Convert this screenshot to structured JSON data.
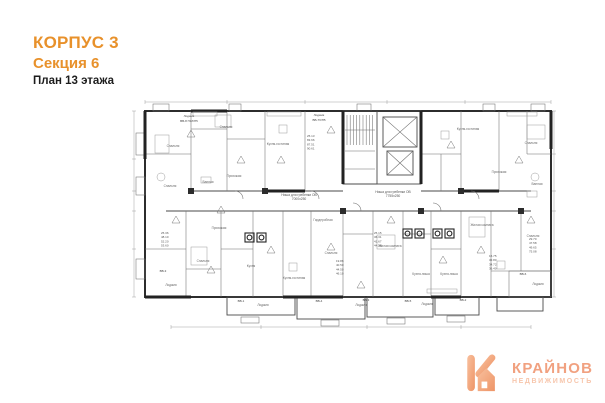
{
  "header": {
    "building": "КОРПУС 3",
    "section": "Секция 6",
    "floor": "План 13 этажа"
  },
  "logo": {
    "name": "КРАЙНОВ",
    "subtitle": "НЕДВИЖИМОСТЬ",
    "accent": "#F0A077"
  },
  "colors": {
    "header_orange": "#E8912B",
    "plan_line": "#3b3b3b",
    "label_gray": "#6b6b6b"
  },
  "plan": {
    "room_labels": [
      {
        "text": "Спальня",
        "x": 42,
        "y": 48
      },
      {
        "text": "Спальня",
        "x": 95,
        "y": 29
      },
      {
        "text": "Кухня-гостиная",
        "x": 147,
        "y": 46
      },
      {
        "text": "Кухня-гостиная",
        "x": 337,
        "y": 31
      },
      {
        "text": "Спальня",
        "x": 400,
        "y": 45
      },
      {
        "text": "Спальня",
        "x": 39,
        "y": 88
      },
      {
        "text": "Прихожая",
        "x": 103,
        "y": 78
      },
      {
        "text": "Ванная",
        "x": 77,
        "y": 84
      },
      {
        "text": "Прихожая",
        "x": 368,
        "y": 74
      },
      {
        "text": "Ванная",
        "x": 406,
        "y": 86
      },
      {
        "text": "Прихожая",
        "x": 88,
        "y": 130
      },
      {
        "text": "Спальня",
        "x": 72,
        "y": 163
      },
      {
        "text": "Кухня",
        "x": 120,
        "y": 168
      },
      {
        "text": "Кухня-гостиная",
        "x": 163,
        "y": 180
      },
      {
        "text": "Спальня",
        "x": 200,
        "y": 155
      },
      {
        "text": "Гардеробная",
        "x": 192,
        "y": 122
      },
      {
        "text": "Жилая комната",
        "x": 259,
        "y": 148
      },
      {
        "text": "Кухня-ниша",
        "x": 290,
        "y": 176
      },
      {
        "text": "Кухня-ниша",
        "x": 318,
        "y": 176
      },
      {
        "text": "Жилая комната",
        "x": 351,
        "y": 127
      },
      {
        "text": "Спальня",
        "x": 402,
        "y": 138
      },
      {
        "text": "Лоджия",
        "x": 40,
        "y": 187
      },
      {
        "text": "Лоджия",
        "x": 132,
        "y": 207
      },
      {
        "text": "Лоджия",
        "x": 230,
        "y": 207
      },
      {
        "text": "Лоджия",
        "x": 296,
        "y": 206
      },
      {
        "text": "Лоджия",
        "x": 407,
        "y": 186
      }
    ],
    "annotations": [
      {
        "text": "Ниша для гребенки ОВ",
        "x": 168,
        "y": 97
      },
      {
        "text": "7000х250",
        "x": 168,
        "y": 101
      },
      {
        "text": "Ниша для гребенки ОВ",
        "x": 262,
        "y": 94
      },
      {
        "text": "7755х250",
        "x": 262,
        "y": 98
      }
    ],
    "apartment_tags": [
      {
        "text": "Лоджия",
        "x": 58,
        "y": 18
      },
      {
        "text": "ВВ-8 П1б/П5",
        "x": 58,
        "y": 23
      },
      {
        "text": "Лоджия",
        "x": 188,
        "y": 17
      },
      {
        "text": "ВВ-7б/П5",
        "x": 188,
        "y": 22
      },
      {
        "text": "ВВ-3",
        "x": 32,
        "y": 173
      },
      {
        "text": "ВВ-1",
        "x": 110,
        "y": 203
      },
      {
        "text": "ВВ-4",
        "x": 188,
        "y": 203
      },
      {
        "text": "ВВ-3",
        "x": 235,
        "y": 202
      },
      {
        "text": "ВВ-5",
        "x": 277,
        "y": 203
      },
      {
        "text": "ВВ-2",
        "x": 332,
        "y": 202
      },
      {
        "text": "ВВ-6",
        "x": 392,
        "y": 176
      }
    ],
    "area_tables": [
      {
        "x": 176,
        "y": 38,
        "values": [
          "25.13",
          "83.66",
          "87.51",
          "90.61"
        ]
      },
      {
        "x": 30,
        "y": 135,
        "values": [
          "25.36",
          "48.10",
          "52.20",
          "53.60"
        ]
      },
      {
        "x": 205,
        "y": 163,
        "values": [
          "19.86",
          "40.50",
          "44.50",
          "46.10"
        ]
      },
      {
        "x": 243,
        "y": 135,
        "values": [
          "25.15",
          "36.31",
          "41.67",
          "44.58"
        ]
      },
      {
        "x": 358,
        "y": 158,
        "values": [
          "15.75",
          "32.80",
          "34.72",
          "36.40"
        ]
      },
      {
        "x": 398,
        "y": 141,
        "values": [
          "29.70",
          "47.58",
          "49.65",
          "75.08"
        ]
      }
    ]
  }
}
